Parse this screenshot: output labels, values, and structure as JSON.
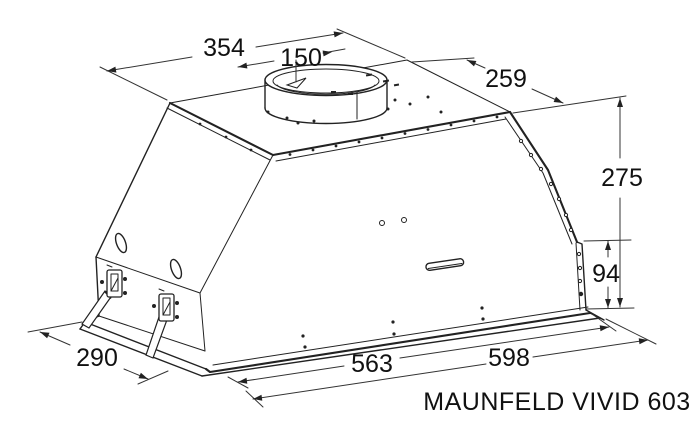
{
  "title": "MAUNFELD VIVID 603",
  "dimensions": {
    "top_width": "354",
    "duct_diameter": "150",
    "top_depth": "259",
    "total_height": "275",
    "front_lower_height": "94",
    "base_depth": "290",
    "body_width": "563",
    "base_width": "598"
  },
  "colors": {
    "line": "#222222",
    "text": "#111111",
    "background": "#ffffff"
  }
}
